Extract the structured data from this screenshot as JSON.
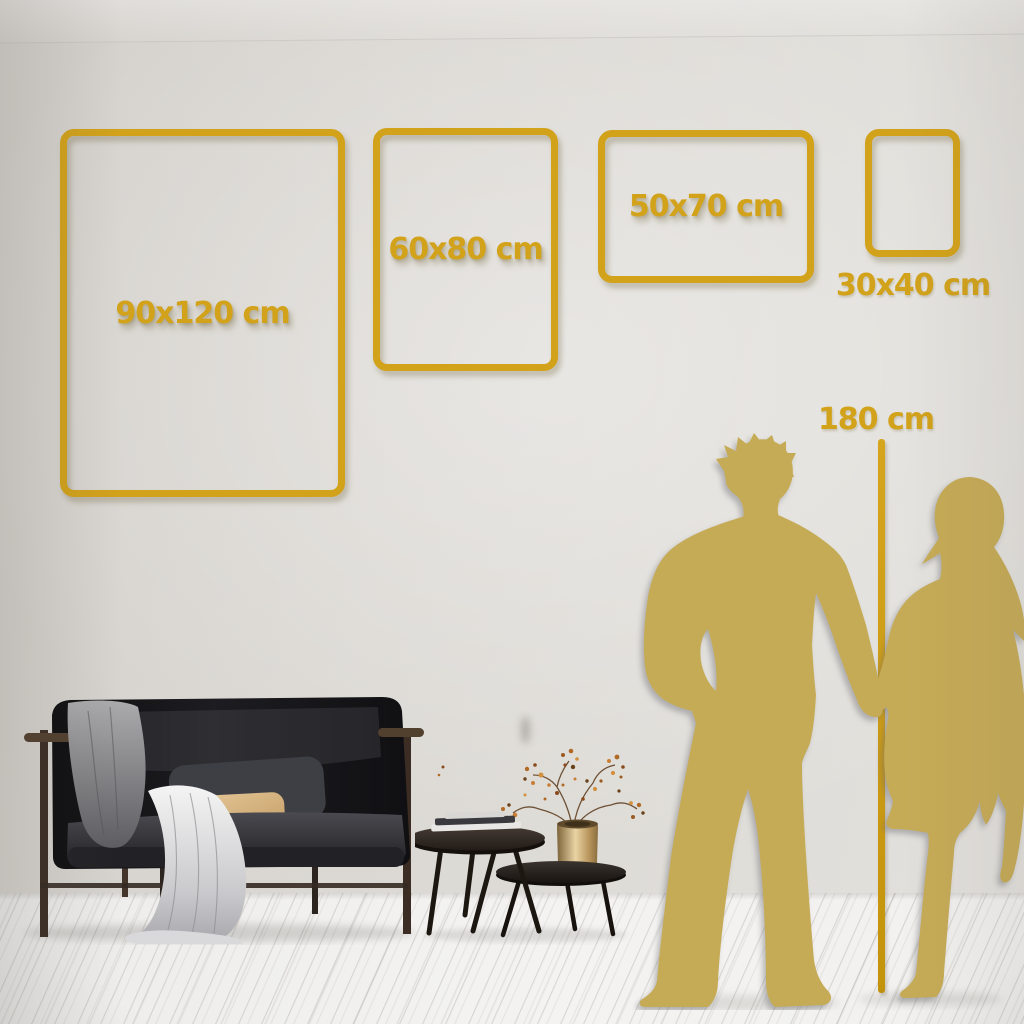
{
  "frames": [
    {
      "id": "frame-90x120",
      "size_label": "90x120 cm"
    },
    {
      "id": "frame-60x80",
      "size_label": "60x80 cm"
    },
    {
      "id": "frame-50x70",
      "size_label": "50x70 cm"
    },
    {
      "id": "frame-30x40",
      "size_label": "30x40 cm"
    }
  ],
  "height_marker": {
    "label": "180 cm"
  },
  "colors": {
    "accent_gold": "#D2A21B",
    "silhouette_gold": "#C6AB57",
    "wall": "#DCD9D4",
    "floor": "#F2F1EF"
  }
}
